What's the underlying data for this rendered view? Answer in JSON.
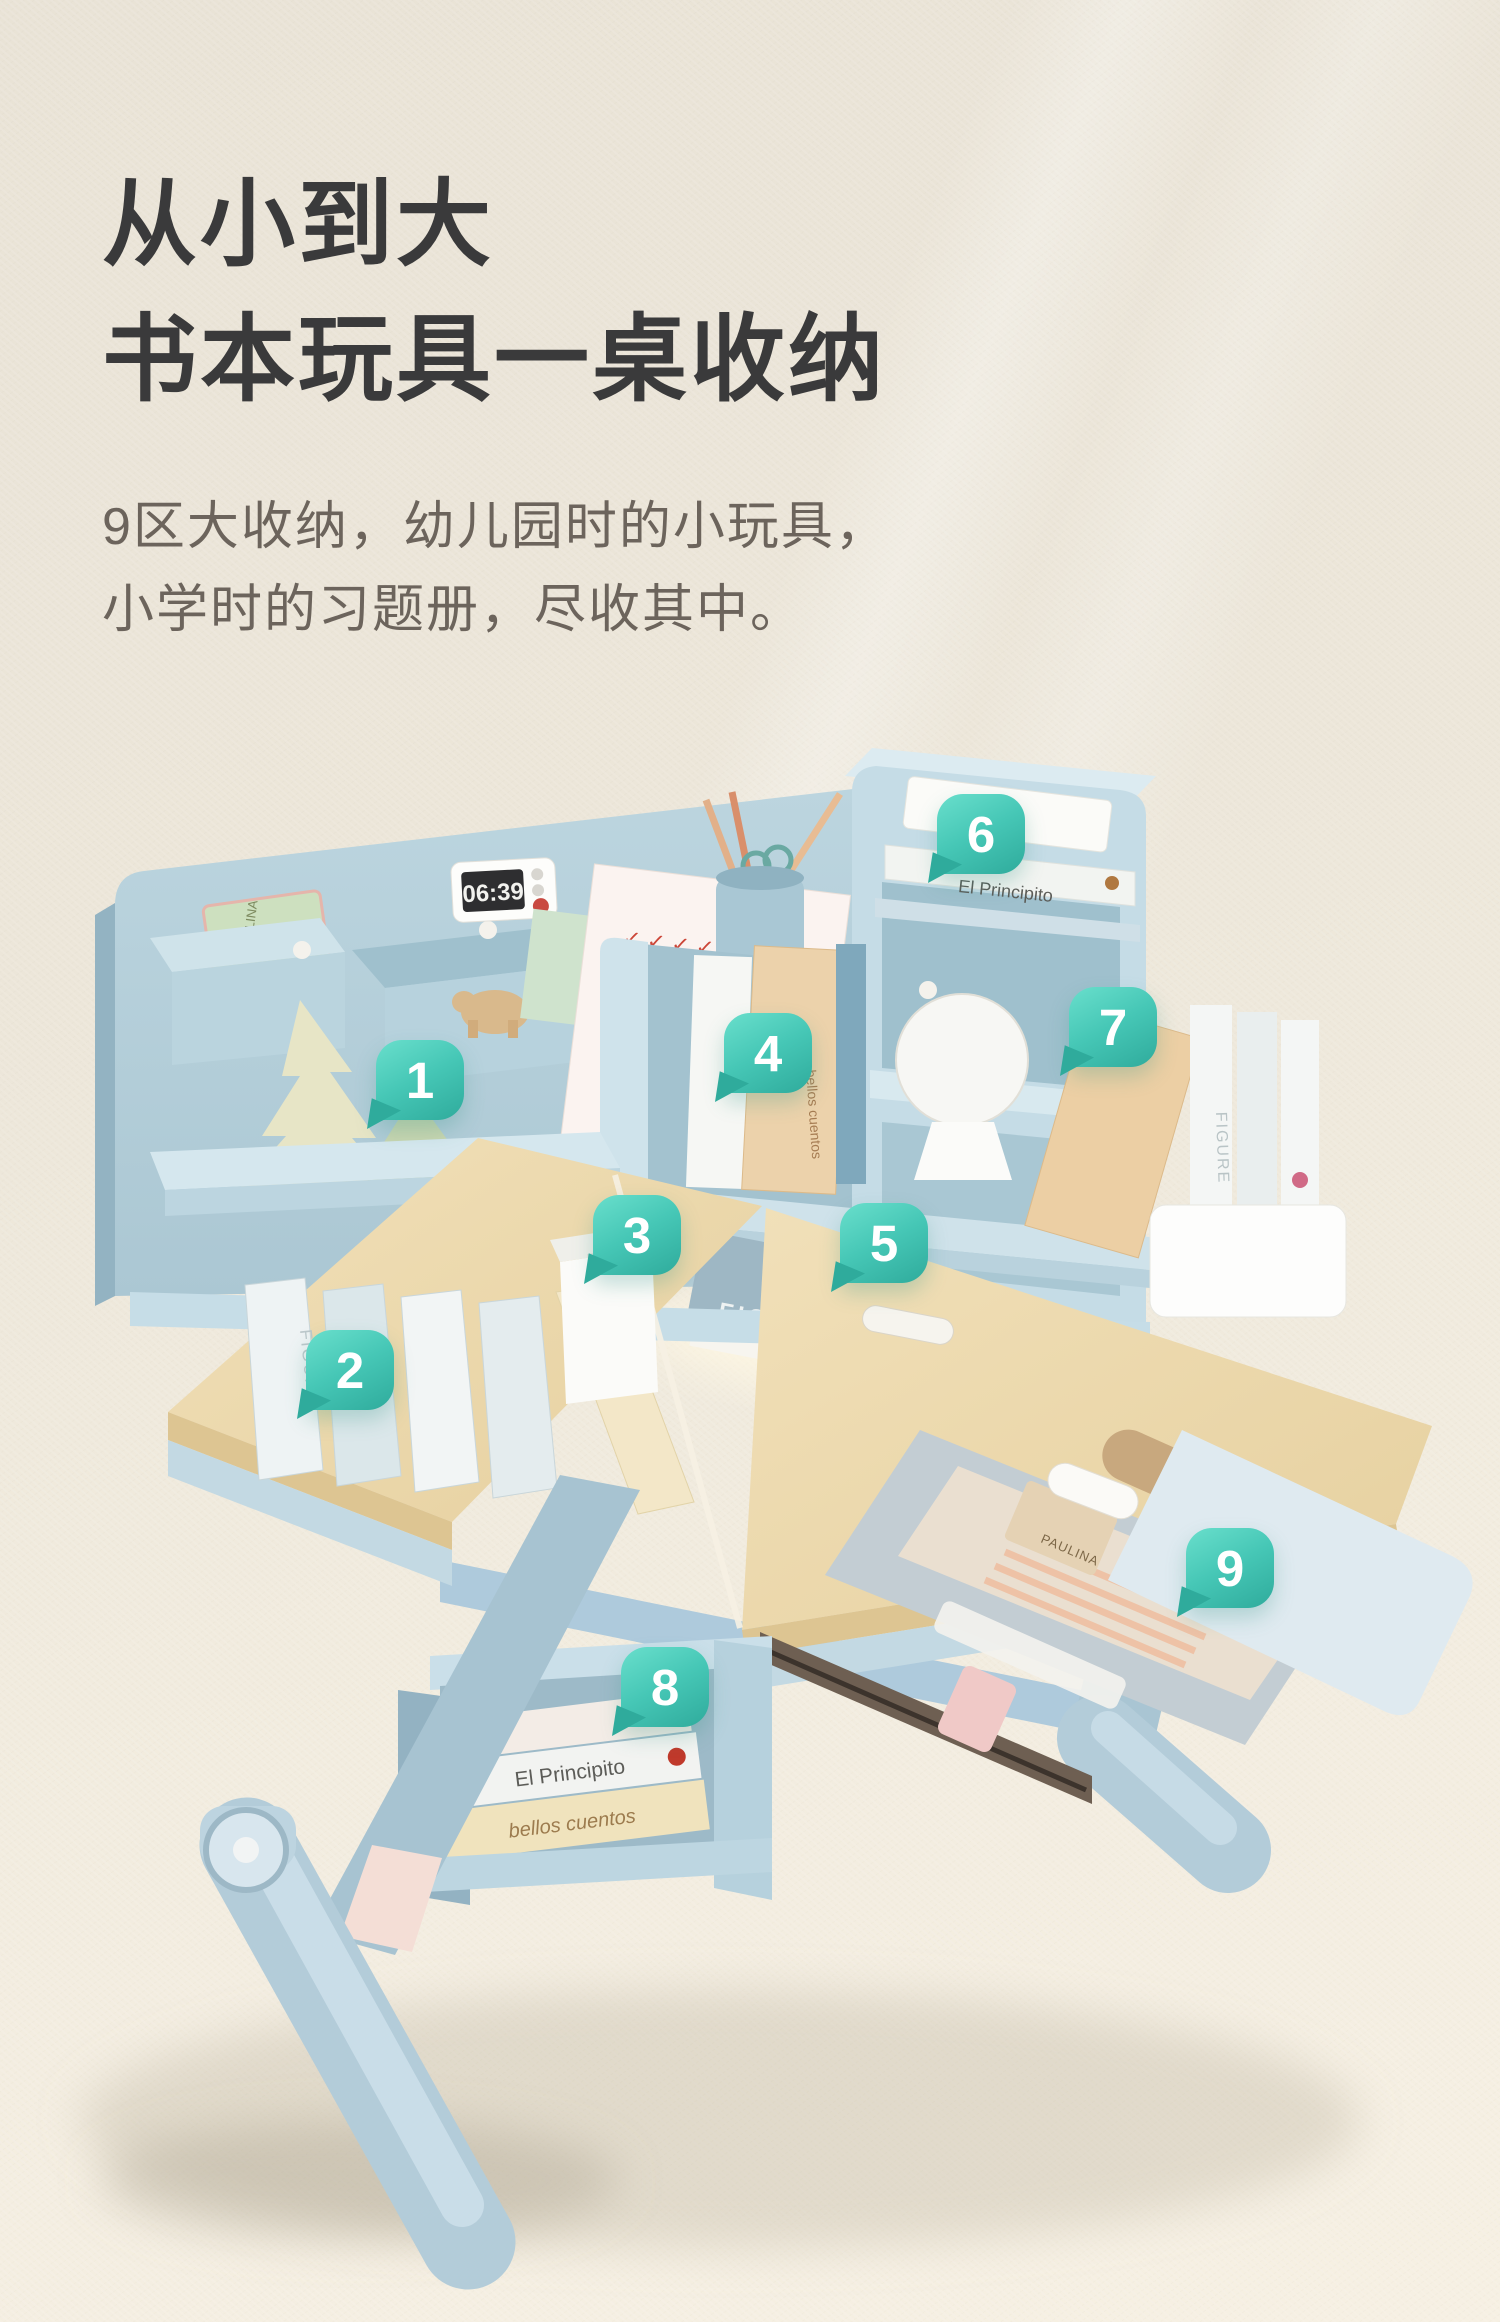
{
  "header": {
    "title_line1": "从小到大",
    "title_line2": "书本玩具一桌收纳",
    "subtitle_line1": "9区大收纳，幼儿园时的小玩具，",
    "subtitle_line2": "小学时的习题册，尽收其中。"
  },
  "callouts": [
    {
      "number": "1"
    },
    {
      "number": "2"
    },
    {
      "number": "3"
    },
    {
      "number": "4"
    },
    {
      "number": "5"
    },
    {
      "number": "6"
    },
    {
      "number": "7"
    },
    {
      "number": "8"
    },
    {
      "number": "9"
    }
  ],
  "photo": {
    "timer_display": "06:39",
    "brand_label": "黑白调",
    "labels": {
      "principito": "El Principito",
      "cuentos": "bellos cuentos",
      "figure": "FIGURE",
      "paulina": "PAULINA"
    },
    "checkmarks_row": "✓  ✓  ✓  ✓  ✓"
  },
  "colors": {
    "badge_gradient_start": "#69dfcc",
    "badge_gradient_end": "#2fab9c",
    "desk_blue": "#b7d1db",
    "desk_blue_light": "#cfe2ea",
    "wood": "#eedcb2",
    "background": "#eee8db",
    "title_text": "#3a3a3b",
    "subtitle_text": "#6c645c"
  }
}
